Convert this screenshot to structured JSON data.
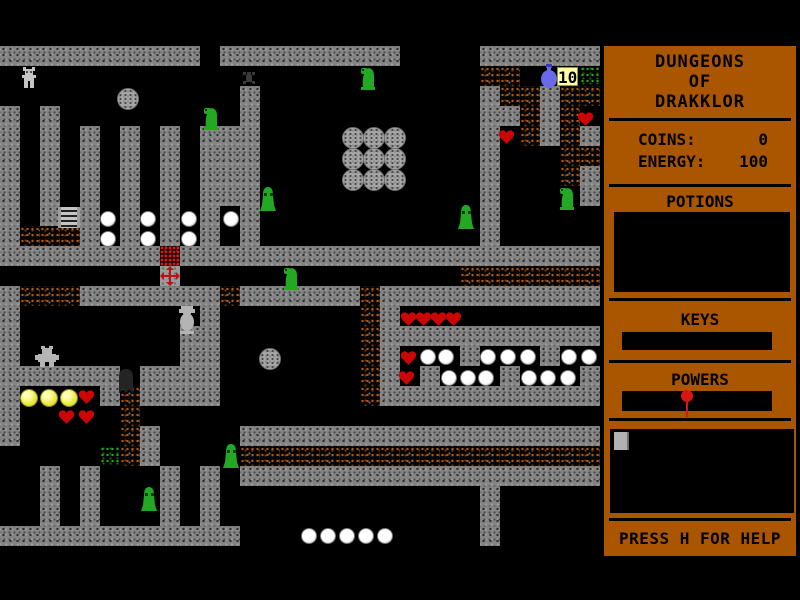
{
  "window": {
    "width": 800,
    "height": 600,
    "background": "#000000"
  },
  "map": {
    "origin_x": 0,
    "origin_y": 46,
    "tile_size": 20,
    "cols": 30,
    "rows": 26,
    "legend": {
      "#": "gray-wall",
      ".": "black-floor",
      "d": "dirt-rubble",
      "g": "grass-patch",
      "r": "red-rubble",
      "x": "gray-pad"
    },
    "tiles": [
      "##########.#########....######",
      "........................dd...g",
      "............#...........#dd#dd",
      "#.#.........#...........##d#d.",
      "#.#.#.#.#.###...........#.d#d#",
      "#.#.#.#.#.###...........#...dd",
      "#.#.#.#.#.###...........#...d#",
      "#.#.#.#.#.###...........#....#",
      "#.#.#.#.#.#.#...........#.....",
      "#ddd#.#.#.#.#...........#.....",
      "########r#####################",
      "........x..............ddddddd",
      "#ddd#######d######d###########",
      "#.........#.......d#..........",
      "#........##.......d###########",
      "#........##.......d#...#...#..",
      "######.####.......d#.#...#...#",
      "#....#d####.......d###########",
      "#.....d.......................",
      "#.....d#....##################",
      ".....gd#....dddddddddddddddddd",
      "..#.#...#.#.##################",
      "..#.#...#.#.............#.....",
      "..#.#...#.#.............#.....",
      "############............#.....",
      ".............................."
    ]
  },
  "sprites": [
    {
      "type": "player",
      "x": 21,
      "y": 67
    },
    {
      "type": "boulder",
      "x": 117,
      "y": 88
    },
    {
      "type": "boulder",
      "x": 342,
      "y": 127
    },
    {
      "type": "boulder",
      "x": 363,
      "y": 127
    },
    {
      "type": "boulder",
      "x": 384,
      "y": 127
    },
    {
      "type": "boulder",
      "x": 342,
      "y": 148
    },
    {
      "type": "boulder",
      "x": 363,
      "y": 148
    },
    {
      "type": "boulder",
      "x": 384,
      "y": 148
    },
    {
      "type": "boulder",
      "x": 342,
      "y": 169
    },
    {
      "type": "boulder",
      "x": 363,
      "y": 169
    },
    {
      "type": "boulder",
      "x": 384,
      "y": 169
    },
    {
      "type": "boulder",
      "x": 259,
      "y": 348
    },
    {
      "type": "bug",
      "x": 241,
      "y": 70
    },
    {
      "type": "duck-slime",
      "x": 201,
      "y": 106
    },
    {
      "type": "duck-slime",
      "x": 358,
      "y": 66
    },
    {
      "type": "duck-slime",
      "x": 557,
      "y": 186
    },
    {
      "type": "duck-slime",
      "x": 281,
      "y": 266
    },
    {
      "type": "bell-slime",
      "x": 259,
      "y": 186
    },
    {
      "type": "bell-slime",
      "x": 457,
      "y": 204
    },
    {
      "type": "bell-slime",
      "x": 222,
      "y": 443
    },
    {
      "type": "bell-slime",
      "x": 140,
      "y": 486
    },
    {
      "type": "flask",
      "x": 539,
      "y": 64
    },
    {
      "type": "counter",
      "x": 557,
      "y": 67,
      "text": "10"
    },
    {
      "type": "ladder",
      "x": 58,
      "y": 207
    },
    {
      "type": "cross-pad",
      "x": 160,
      "y": 266
    },
    {
      "type": "statue",
      "x": 176,
      "y": 306
    },
    {
      "type": "gray-creature",
      "x": 35,
      "y": 346
    },
    {
      "type": "dark-creature",
      "x": 115,
      "y": 367
    },
    {
      "type": "heart",
      "x": 577,
      "y": 111
    },
    {
      "type": "heart",
      "x": 498,
      "y": 129
    },
    {
      "type": "heart",
      "x": 400,
      "y": 311
    },
    {
      "type": "heart",
      "x": 415,
      "y": 311
    },
    {
      "type": "heart",
      "x": 430,
      "y": 311
    },
    {
      "type": "heart",
      "x": 445,
      "y": 311
    },
    {
      "type": "heart",
      "x": 400,
      "y": 350
    },
    {
      "type": "heart",
      "x": 398,
      "y": 370
    },
    {
      "type": "heart",
      "x": 78,
      "y": 389
    },
    {
      "type": "heart",
      "x": 58,
      "y": 409
    },
    {
      "type": "heart",
      "x": 78,
      "y": 409
    },
    {
      "type": "pearl",
      "x": 100,
      "y": 211
    },
    {
      "type": "pearl",
      "x": 140,
      "y": 211
    },
    {
      "type": "pearl",
      "x": 181,
      "y": 211
    },
    {
      "type": "pearl",
      "x": 223,
      "y": 211
    },
    {
      "type": "pearl",
      "x": 100,
      "y": 231
    },
    {
      "type": "pearl",
      "x": 140,
      "y": 231
    },
    {
      "type": "pearl",
      "x": 181,
      "y": 231
    },
    {
      "type": "pearl",
      "x": 420,
      "y": 349
    },
    {
      "type": "pearl",
      "x": 438,
      "y": 349
    },
    {
      "type": "pearl",
      "x": 480,
      "y": 349
    },
    {
      "type": "pearl",
      "x": 500,
      "y": 349
    },
    {
      "type": "pearl",
      "x": 520,
      "y": 349
    },
    {
      "type": "pearl",
      "x": 561,
      "y": 349
    },
    {
      "type": "pearl",
      "x": 581,
      "y": 349
    },
    {
      "type": "pearl",
      "x": 441,
      "y": 370
    },
    {
      "type": "pearl",
      "x": 460,
      "y": 370
    },
    {
      "type": "pearl",
      "x": 478,
      "y": 370
    },
    {
      "type": "pearl",
      "x": 521,
      "y": 370
    },
    {
      "type": "pearl",
      "x": 540,
      "y": 370
    },
    {
      "type": "pearl",
      "x": 560,
      "y": 370
    },
    {
      "type": "pearl",
      "x": 301,
      "y": 528
    },
    {
      "type": "pearl",
      "x": 320,
      "y": 528
    },
    {
      "type": "pearl",
      "x": 339,
      "y": 528
    },
    {
      "type": "pearl",
      "x": 358,
      "y": 528
    },
    {
      "type": "pearl",
      "x": 377,
      "y": 528
    },
    {
      "type": "yellow-ball",
      "x": 20,
      "y": 389
    },
    {
      "type": "yellow-ball",
      "x": 40,
      "y": 389
    },
    {
      "type": "yellow-ball",
      "x": 60,
      "y": 389
    }
  ],
  "sidebar": {
    "background": "#aa5500",
    "title_lines": [
      "DUNGEONS",
      "OF",
      "DRAKKLOR"
    ],
    "stats": [
      {
        "label": "COINS:",
        "value": "0"
      },
      {
        "label": "ENERGY:",
        "value": "100"
      }
    ],
    "sections": {
      "potions": "POTIONS",
      "keys": "KEYS",
      "powers": "POWERS"
    },
    "help": "PRESS H FOR HELP"
  },
  "colors": {
    "panel": "#aa5500",
    "wall": "#848484",
    "dirt_speckle": "#b05a14",
    "slime_green": "#22a822",
    "heart_red": "#cc0505",
    "flask_blue": "#6a6ae8",
    "coin_yellow": "#ecec52",
    "counter_bg": "#ffffa6"
  }
}
